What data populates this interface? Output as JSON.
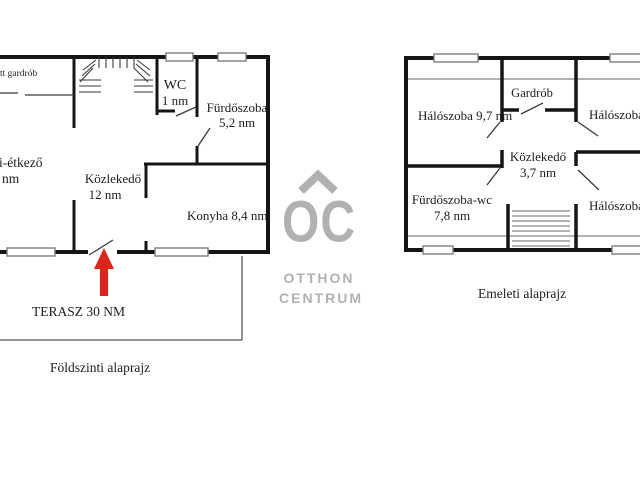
{
  "ground_floor": {
    "gardrob_partial": "tt gardrób",
    "wc": "WC",
    "wc_area": "1 nm",
    "furdoszoba": "Fürdőszoba",
    "furdoszoba_area": "5,2 nm",
    "etkezo_partial": "i-étkező",
    "etkezo_area_partial": "nm",
    "kozlekedo": "Közlekedő",
    "kozlekedo_area": "12 nm",
    "konyha": "Konyha 8,4 nm",
    "terasz": "TERASZ 30 NM",
    "caption": "Földszinti alaprajz"
  },
  "upper_floor": {
    "haloszoba1": "Hálószoba 9,7 nm",
    "gardrob": "Gardrób",
    "haloszoba2_partial": "Hálószoba",
    "kozlekedo": "Közlekedő",
    "kozlekedo_area": "3,7 nm",
    "furdoszoba_wc": "Fürdőszoba-wc",
    "furdoszoba_wc_area": "7,8 nm",
    "haloszoba3_partial": "Hálószoba",
    "caption": "Emeleti alaprajz"
  },
  "logo": {
    "monogram": "OC",
    "name_line1": "OTTHON",
    "name_line2": "CENTRUM"
  },
  "colors": {
    "wall_black": "#151515",
    "arrow_red": "#e02318",
    "logo_gray": "#b3b0b0"
  }
}
